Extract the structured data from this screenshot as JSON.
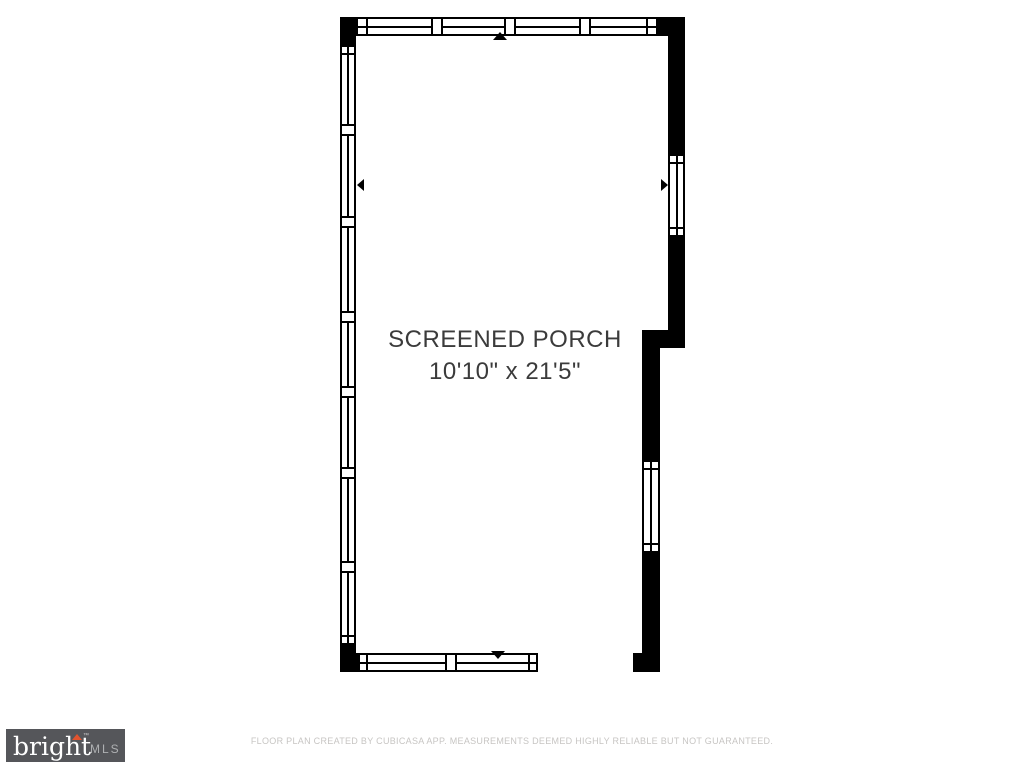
{
  "floorplan": {
    "room_label": "SCREENED PORCH",
    "room_dimensions": "10'10\" x 21'5\""
  },
  "footer": {
    "logo": {
      "brand": "bright",
      "trademark": "™",
      "suffix": "MLS"
    },
    "disclaimer": "FLOOR PLAN CREATED BY CUBICASA APP. MEASUREMENTS DEEMED HIGHLY RELIABLE BUT NOT GUARANTEED."
  },
  "colors": {
    "wall": "#000000",
    "room_text": "#3b3b3b",
    "logo_bg": "#55565a",
    "logo_brand": "#ffffff",
    "logo_suffix": "#aeb0b2",
    "logo_accent": "#e2532e",
    "disclaimer_text": "#c7c5c3"
  }
}
